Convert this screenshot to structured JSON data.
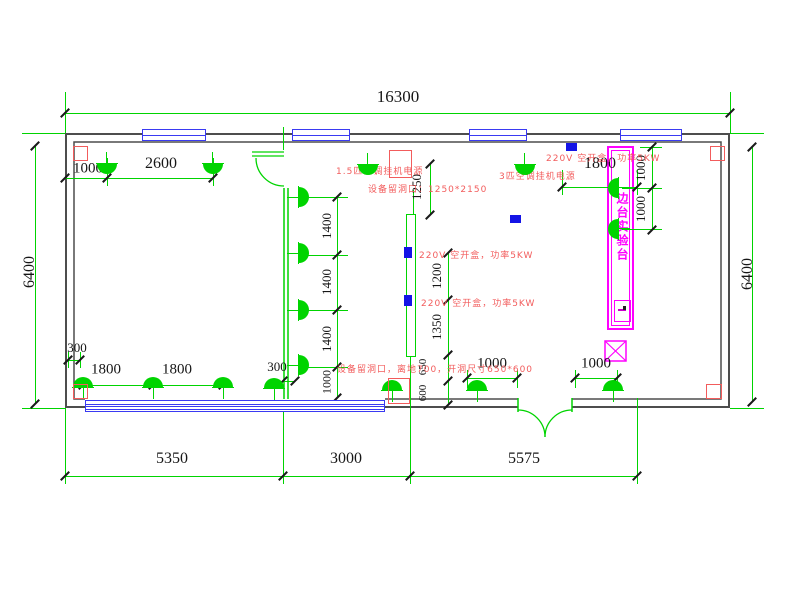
{
  "drawing": {
    "type": "electrical-lighting-floor-plan",
    "overall": {
      "width_mm": "16300",
      "depth_mm": "6400"
    },
    "colors": {
      "line_green": "#00d400",
      "wall_gray": "#4d4d4d",
      "window_blue": "#3a3af2",
      "annotation_red": "#f25c5c",
      "bench_magenta": "#ff00ff",
      "power_box_blue": "#1414e6",
      "dim_text": "#161616"
    },
    "bench": {
      "label": "边台实验台"
    },
    "dim_labels": [
      {
        "t": "16300",
        "x": 398,
        "y": 97,
        "r": 0,
        "s": 17
      },
      {
        "t": "6400",
        "x": 30,
        "y": 272,
        "r": -90,
        "s": 16
      },
      {
        "t": "6400",
        "x": 748,
        "y": 274,
        "r": -90,
        "s": 16
      },
      {
        "t": "1000",
        "x": 88,
        "y": 169,
        "r": 0,
        "s": 15
      },
      {
        "t": "2600",
        "x": 161,
        "y": 164,
        "r": 0,
        "s": 16
      },
      {
        "t": "1800",
        "x": 600,
        "y": 164,
        "r": 0,
        "s": 16
      },
      {
        "t": "1000",
        "x": 641,
        "y": 168,
        "r": -90,
        "s": 13
      },
      {
        "t": "1000",
        "x": 641,
        "y": 209,
        "r": -90,
        "s": 13
      },
      {
        "t": "1250",
        "x": 417,
        "y": 187,
        "r": -90,
        "s": 13
      },
      {
        "t": "1400",
        "x": 327,
        "y": 226,
        "r": -90,
        "s": 13
      },
      {
        "t": "1400",
        "x": 327,
        "y": 282,
        "r": -90,
        "s": 13
      },
      {
        "t": "1400",
        "x": 327,
        "y": 339,
        "r": -90,
        "s": 13
      },
      {
        "t": "1000",
        "x": 327,
        "y": 382,
        "r": -90,
        "s": 12
      },
      {
        "t": "1200",
        "x": 437,
        "y": 276,
        "r": -90,
        "s": 13
      },
      {
        "t": "1350",
        "x": 437,
        "y": 327,
        "r": -90,
        "s": 13
      },
      {
        "t": "650",
        "x": 423,
        "y": 367,
        "r": -90,
        "s": 11
      },
      {
        "t": "600",
        "x": 423,
        "y": 393,
        "r": -90,
        "s": 11
      },
      {
        "t": "300",
        "x": 77,
        "y": 348,
        "r": 0,
        "s": 13
      },
      {
        "t": "1800",
        "x": 106,
        "y": 370,
        "r": 0,
        "s": 15
      },
      {
        "t": "1800",
        "x": 177,
        "y": 370,
        "r": 0,
        "s": 15
      },
      {
        "t": "300",
        "x": 277,
        "y": 367,
        "r": 0,
        "s": 13
      },
      {
        "t": "1000",
        "x": 492,
        "y": 364,
        "r": 0,
        "s": 15
      },
      {
        "t": "1000",
        "x": 596,
        "y": 364,
        "r": 0,
        "s": 15
      },
      {
        "t": "5350",
        "x": 172,
        "y": 459,
        "r": 0,
        "s": 16
      },
      {
        "t": "3000",
        "x": 346,
        "y": 459,
        "r": 0,
        "s": 16
      },
      {
        "t": "5575",
        "x": 524,
        "y": 459,
        "r": 0,
        "s": 16
      }
    ],
    "red_annotations": [
      {
        "t": "1.5匹空调挂机电源",
        "x": 336,
        "y": 164
      },
      {
        "t": "3匹空调挂机电源",
        "x": 499,
        "y": 169
      },
      {
        "t": "设备留洞口：1250*2150",
        "x": 368,
        "y": 182
      },
      {
        "t": "220V 空开盒，功率5KW",
        "x": 546,
        "y": 151
      },
      {
        "t": "220V 空开盒，功率5KW",
        "x": 419,
        "y": 248
      },
      {
        "t": "220V 空开盒，功率5KW",
        "x": 421,
        "y": 296
      },
      {
        "t": "设备留洞口，离地700，开洞尺寸650*600",
        "x": 337,
        "y": 362
      }
    ],
    "lamps": [
      [
        107,
        164,
        "down"
      ],
      [
        213,
        164,
        "down"
      ],
      [
        368,
        165,
        "down"
      ],
      [
        525,
        165,
        "down"
      ],
      [
        83,
        387,
        "up"
      ],
      [
        153,
        387,
        "up"
      ],
      [
        223,
        387,
        "up"
      ],
      [
        274,
        388,
        "up"
      ],
      [
        392,
        390,
        "up"
      ],
      [
        477,
        390,
        "up"
      ],
      [
        613,
        390,
        "up"
      ],
      [
        299,
        197,
        "right"
      ],
      [
        299,
        253,
        "right"
      ],
      [
        299,
        310,
        "right"
      ],
      [
        299,
        365,
        "right"
      ],
      [
        618,
        188,
        "left"
      ],
      [
        618,
        229,
        "left"
      ]
    ],
    "windows_top": [
      [
        142,
        64
      ],
      [
        292,
        58
      ],
      [
        469,
        58
      ],
      [
        620,
        62
      ]
    ],
    "window_bottom": {
      "x": 85,
      "y": 400,
      "w": 300,
      "h": 12
    },
    "power_boxes": [
      [
        566,
        143,
        11,
        8
      ],
      [
        510,
        215,
        11,
        8
      ],
      [
        404,
        247,
        8,
        11
      ],
      [
        404,
        295,
        8,
        11
      ]
    ],
    "red_outlines": [
      [
        389,
        150,
        23,
        28
      ],
      [
        388,
        378,
        22,
        26
      ],
      [
        73,
        146,
        15,
        15
      ],
      [
        73,
        384,
        15,
        15
      ],
      [
        710,
        146,
        15,
        15
      ],
      [
        706,
        384,
        16,
        15
      ]
    ],
    "dim_lines_h": [
      [
        65,
        730,
        113
      ],
      [
        65,
        213,
        178
      ],
      [
        562,
        637,
        187
      ],
      [
        68,
        80,
        360
      ],
      [
        83,
        223,
        385
      ],
      [
        283,
        295,
        381
      ],
      [
        467,
        517,
        378
      ],
      [
        575,
        617,
        378
      ],
      [
        65,
        637,
        476
      ]
    ],
    "dim_lines_v": [
      [
        35,
        146,
        404
      ],
      [
        752,
        147,
        402
      ],
      [
        652,
        147,
        230
      ],
      [
        430,
        164,
        215
      ],
      [
        448,
        253,
        405
      ],
      [
        337,
        197,
        398
      ]
    ],
    "ext_lines": [
      [
        65,
        92,
        65,
        133
      ],
      [
        730,
        92,
        730,
        133
      ],
      [
        22,
        133,
        65,
        133
      ],
      [
        22,
        408,
        65,
        408
      ],
      [
        730,
        133,
        764,
        133
      ],
      [
        730,
        408,
        764,
        408
      ],
      [
        65,
        408,
        65,
        484
      ],
      [
        283,
        400,
        283,
        484
      ],
      [
        410,
        357,
        410,
        484
      ],
      [
        637,
        398,
        637,
        484
      ],
      [
        107,
        158,
        107,
        186
      ],
      [
        213,
        158,
        213,
        186
      ],
      [
        562,
        170,
        562,
        195
      ],
      [
        637,
        170,
        637,
        195
      ],
      [
        640,
        147,
        662,
        147
      ],
      [
        622,
        188,
        662,
        188
      ],
      [
        622,
        229,
        662,
        229
      ],
      [
        300,
        197,
        348,
        197
      ],
      [
        300,
        255,
        348,
        255
      ],
      [
        300,
        310,
        348,
        310
      ],
      [
        300,
        367,
        348,
        367
      ],
      [
        467,
        370,
        467,
        388
      ],
      [
        517,
        370,
        517,
        388
      ],
      [
        575,
        370,
        575,
        388
      ],
      [
        617,
        370,
        617,
        388
      ],
      [
        68,
        352,
        68,
        368
      ],
      [
        80,
        352,
        80,
        368
      ],
      [
        283,
        127,
        283,
        150
      ],
      [
        413,
        190,
        413,
        214
      ]
    ],
    "ticks": [
      [
        65,
        113
      ],
      [
        730,
        113
      ],
      [
        65,
        178
      ],
      [
        107,
        178
      ],
      [
        213,
        178
      ],
      [
        562,
        187
      ],
      [
        637,
        187
      ],
      [
        652,
        147
      ],
      [
        652,
        188
      ],
      [
        652,
        230
      ],
      [
        430,
        164
      ],
      [
        430,
        215
      ],
      [
        448,
        253
      ],
      [
        448,
        300
      ],
      [
        448,
        355
      ],
      [
        448,
        381
      ],
      [
        448,
        405
      ],
      [
        337,
        197
      ],
      [
        337,
        255
      ],
      [
        337,
        310
      ],
      [
        337,
        367
      ],
      [
        337,
        398
      ],
      [
        68,
        360
      ],
      [
        80,
        360
      ],
      [
        83,
        385
      ],
      [
        153,
        385
      ],
      [
        223,
        385
      ],
      [
        283,
        381
      ],
      [
        295,
        381
      ],
      [
        467,
        378
      ],
      [
        517,
        378
      ],
      [
        575,
        378
      ],
      [
        617,
        378
      ],
      [
        65,
        476
      ],
      [
        283,
        476
      ],
      [
        410,
        476
      ],
      [
        637,
        476
      ],
      [
        35,
        146
      ],
      [
        35,
        404
      ],
      [
        752,
        147
      ],
      [
        752,
        402
      ]
    ]
  }
}
